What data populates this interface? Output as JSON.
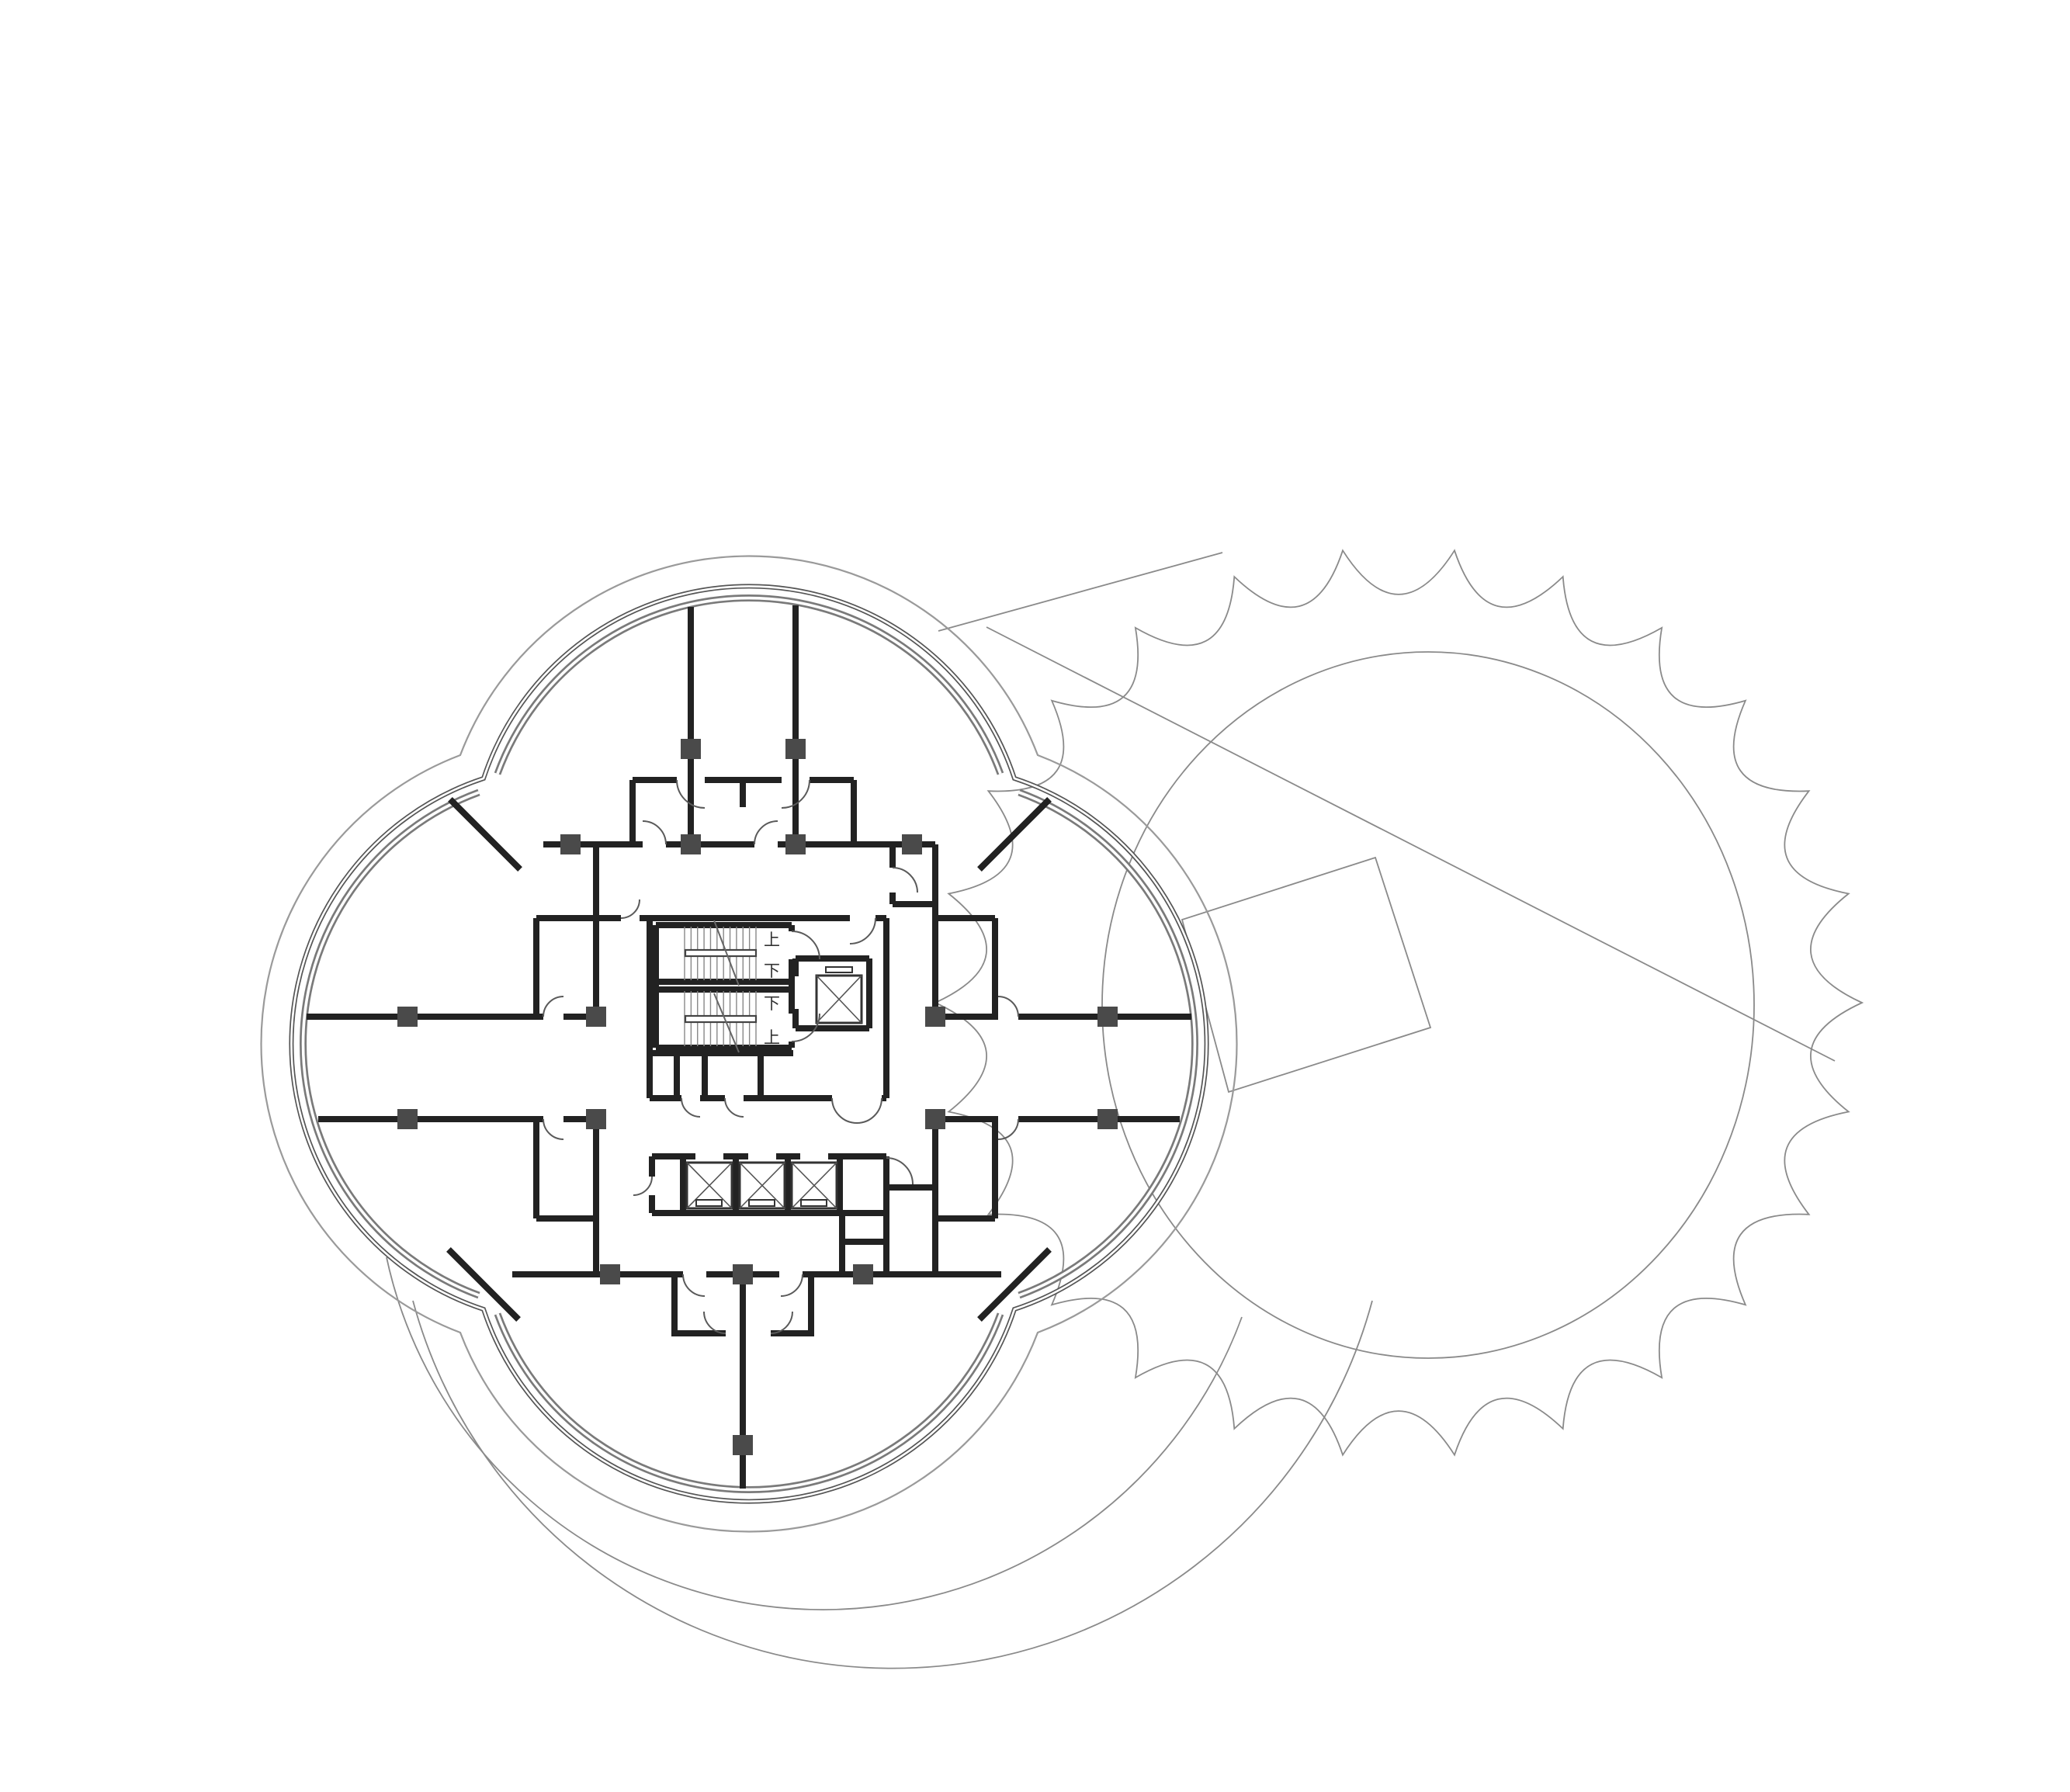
{
  "drawing": {
    "type": "architectural-floor-plan",
    "core": {
      "stair_a": {
        "up_label": "上",
        "down_label": "下"
      },
      "stair_b": {
        "up_label": "上",
        "down_label": "下"
      }
    },
    "colors": {
      "background": "#ffffff",
      "wall": "#222222",
      "wall_core": "#ffffff",
      "outer_wall": "#555555",
      "curtain_wall": "#7a7a7a",
      "column": "#4a4a4a",
      "door_swing": "#5a5a5a",
      "stair_tread": "#888888",
      "offset_line": "#9a9a9a",
      "context_line": "#8a8a8a",
      "label": "#333333"
    }
  }
}
